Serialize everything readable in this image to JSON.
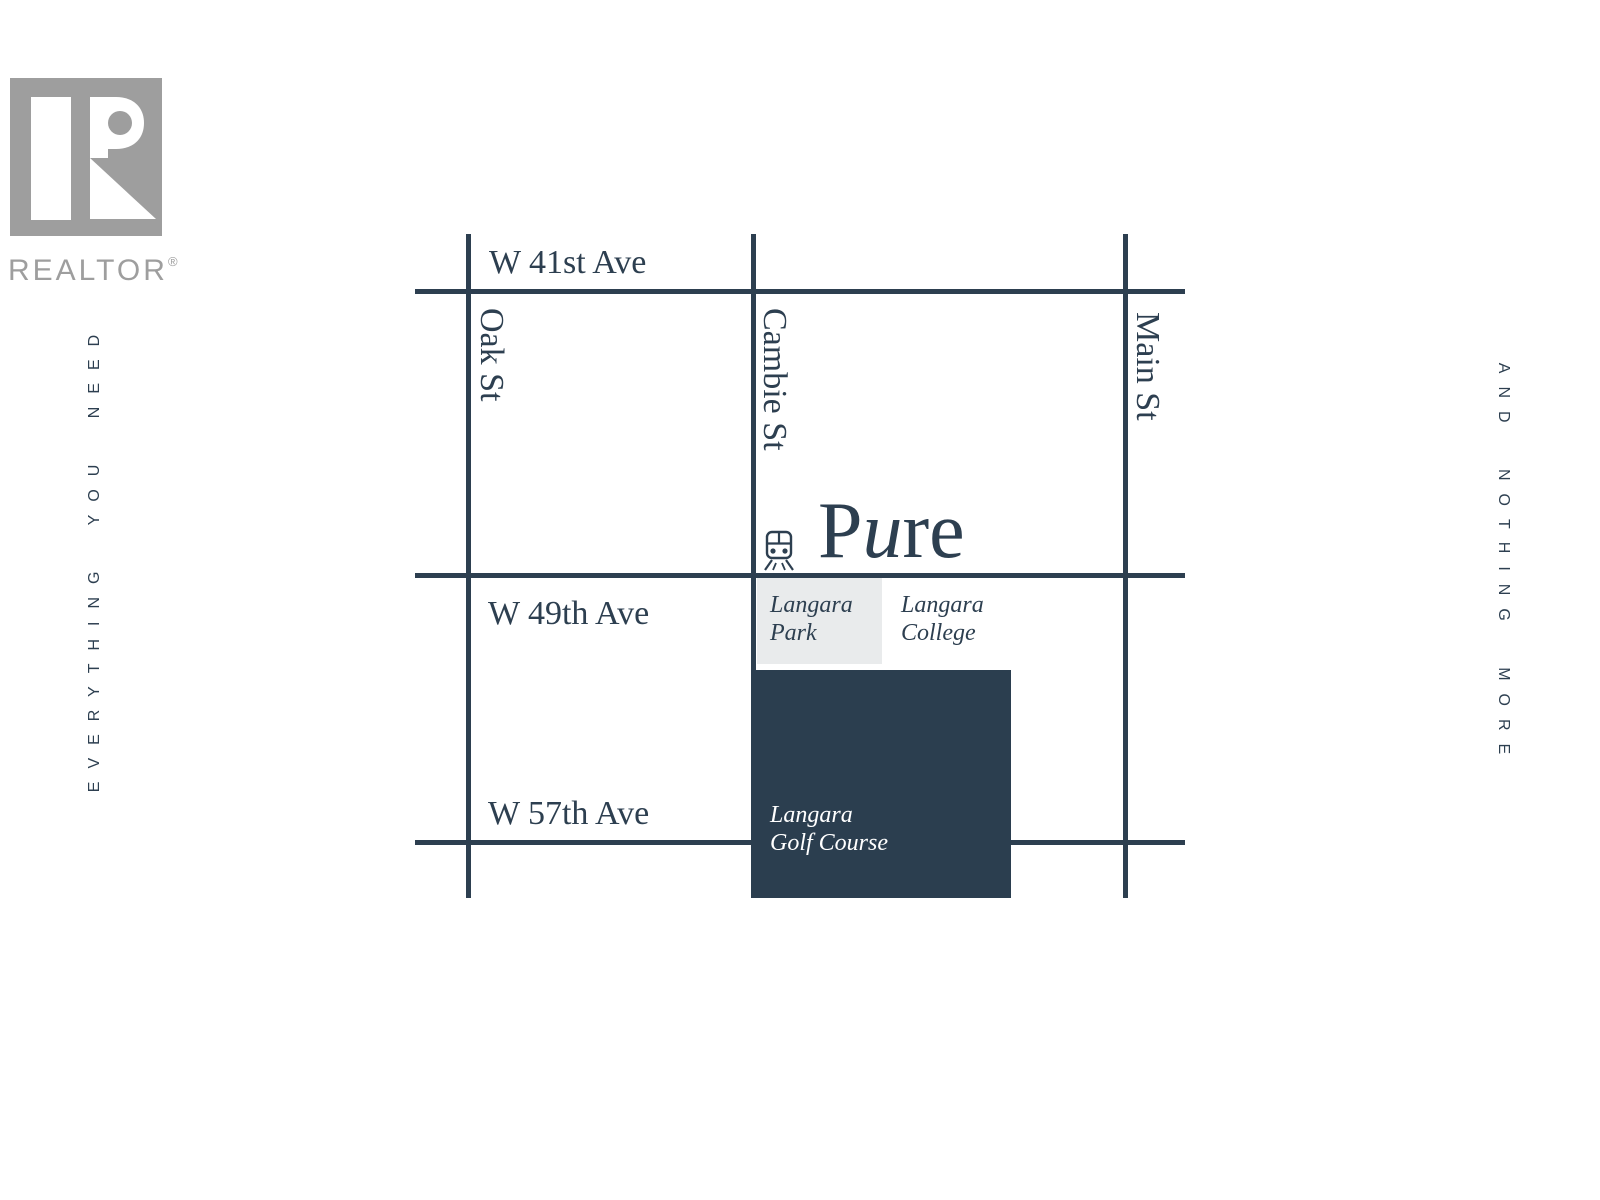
{
  "branding": {
    "logo_text": "REALTOR",
    "registered_mark": "®"
  },
  "taglines": {
    "left": "EVERYTHING YOU NEED",
    "right": "AND NOTHING MORE"
  },
  "map": {
    "brand": {
      "p": "P",
      "u": "u",
      "re": "re"
    },
    "streets": {
      "horizontal": [
        {
          "label": "W 41st Ave"
        },
        {
          "label": "W 49th Ave"
        },
        {
          "label": "W 57th Ave"
        }
      ],
      "vertical": [
        {
          "label": "Oak St"
        },
        {
          "label": "Cambie St"
        },
        {
          "label": "Main St"
        }
      ]
    },
    "landmarks": {
      "park": {
        "line1": "Langara",
        "line2": "Park"
      },
      "college": {
        "line1": "Langara",
        "line2": "College"
      },
      "golf": {
        "line1": "Langara",
        "line2": "Golf Course"
      }
    }
  },
  "icons": {
    "station": "train-station-icon",
    "realtor": "realtor-r-icon"
  },
  "colors": {
    "ink": "#2d3f50",
    "golf_block": "#2b3e4f",
    "park_block": "#e9ebec",
    "logo_gray": "#9e9e9e"
  }
}
